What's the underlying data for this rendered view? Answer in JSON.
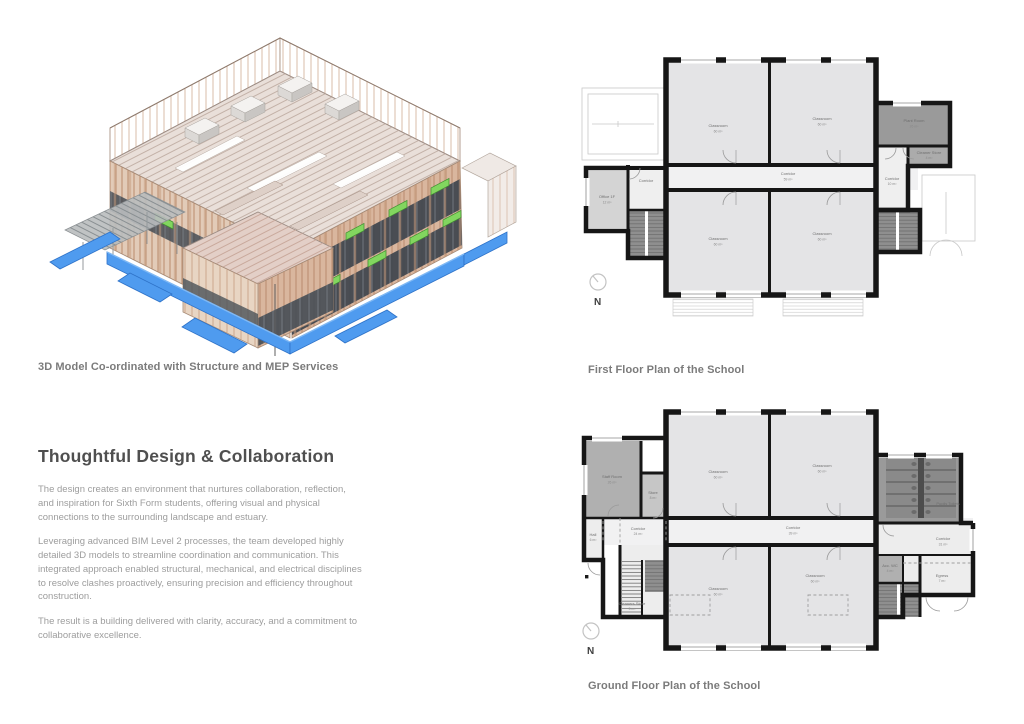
{
  "model_section": {
    "caption": "3D Model Co-ordinated with Structure and MEP Services",
    "illustration_name": "isometric BIM model of timber-frame school building",
    "colors": {
      "foundation_blue": "#4f9bef",
      "mep_green": "#82d65f",
      "timber": "#c9997b",
      "glazing_dark": "#3e454d",
      "roof_deck": "#e9dfd9"
    }
  },
  "text_section": {
    "heading": "Thoughtful Design & Collaboration",
    "paragraphs": [
      "The design creates an environment that nurtures collaboration, reflection, and inspiration for Sixth Form students, offering visual and physical connections to the surrounding landscape and estuary.",
      "Leveraging advanced BIM Level 2 processes, the team developed highly detailed 3D models to streamline coordination and communication. This integrated approach enabled structural, mechanical, and electrical disciplines to resolve clashes proactively, ensuring precision and efficiency throughout construction.",
      "The result is a building delivered with clarity, accuracy, and a commitment to collaborative excellence."
    ]
  },
  "first_floor": {
    "caption": "First Floor Plan of the School",
    "north_label": "N",
    "rooms": {
      "classroom_tl": {
        "label": "Classroom",
        "area": "60 m²"
      },
      "classroom_tr": {
        "label": "Classroom",
        "area": "60 m²"
      },
      "classroom_bl": {
        "label": "Classroom",
        "area": "60 m²"
      },
      "classroom_br": {
        "label": "Classroom",
        "area": "60 m²"
      },
      "corridor": {
        "label": "Corridor",
        "area": "59 m²"
      },
      "corridor_west": {
        "label": "Corridor",
        "area": "10 m²"
      },
      "office": {
        "label": "Office 1F",
        "area": "12 m²"
      },
      "plant_room": {
        "label": "Plant Room",
        "area": "26 m²"
      },
      "cleaner_store": {
        "label": "Cleaner Store",
        "area": "4 m²"
      },
      "corridor_east": {
        "label": "Corridor",
        "area": "10 m²"
      }
    }
  },
  "ground_floor": {
    "caption": "Ground Floor Plan of the School",
    "north_label": "N",
    "rooms": {
      "classroom_tl": {
        "label": "Classroom",
        "area": "60 m²"
      },
      "classroom_tr": {
        "label": "Classroom",
        "area": "60 m²"
      },
      "classroom_bl": {
        "label": "Classroom",
        "area": "60 m²"
      },
      "classroom_br": {
        "label": "Classroom",
        "area": "60 m²"
      },
      "staff_room": {
        "label": "Staff Room",
        "area": "26 m²"
      },
      "store": {
        "label": "Store",
        "area": "8 m²"
      },
      "hall": {
        "label": "Hall",
        "area": "6 m²"
      },
      "corridor_west": {
        "label": "Corridor",
        "area": "24 m²"
      },
      "corridor_center": {
        "label": "Corridor",
        "area": "39 m²"
      },
      "corridor_east": {
        "label": "Corridor",
        "area": "31 m²"
      },
      "toilets": {
        "label": "Pupils Toilets",
        "area": "27 m²"
      },
      "acc_wc": {
        "label": "Acc. WC",
        "area": "4 m²"
      },
      "egress": {
        "label": "Egress",
        "area": "7 m²"
      },
      "cleaners_store": {
        "label": "Cleaners Store",
        "area": "5 m²"
      }
    }
  }
}
